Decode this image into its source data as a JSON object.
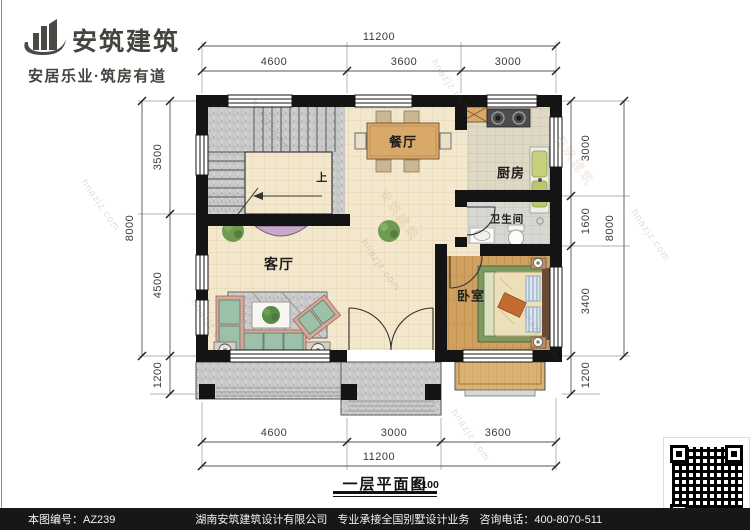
{
  "brand": {
    "name": "安筑建筑",
    "tagline": "安居乐业·筑房有道"
  },
  "plan": {
    "title": "一层平面图",
    "scale": "1:100",
    "rooms": {
      "dining": "餐厅",
      "kitchen": "厨房",
      "bathroom": "卫生间",
      "living": "客厅",
      "bedroom": "卧室",
      "stair_up": "上"
    },
    "dims": {
      "top": {
        "total": "11200",
        "segs": [
          "4600",
          "3600",
          "3000"
        ]
      },
      "bottom": {
        "total": "11200",
        "segs": [
          "4600",
          "3000",
          "3600"
        ]
      },
      "left": {
        "total": "8000",
        "segs": [
          "3500",
          "4500",
          "1200"
        ]
      },
      "right": {
        "total": "8000",
        "segs": [
          "3000",
          "1600",
          "3400",
          "1200"
        ]
      }
    }
  },
  "watermark": {
    "site": "hnazjz.com",
    "brand": "安筑建筑"
  },
  "footer": {
    "plan_no": "本图编号：AZ239",
    "company": "湖南安筑建筑设计有限公司",
    "service": "专业承接全国别墅设计业务",
    "phone": "咨询电话：400-8070-511",
    "web_char": "网"
  },
  "colors": {
    "wall": "#141414",
    "floor_tile": "#f3e8cd",
    "stair_stone": "#c9c9c9",
    "wood_floor": "#cfa05f",
    "sofa_cushion": "#9cc0a8",
    "sofa_frame": "#d8a89c",
    "rug_green": "#7c9a62",
    "table_wood": "#d9a96a",
    "footer_bar": "#171717"
  }
}
